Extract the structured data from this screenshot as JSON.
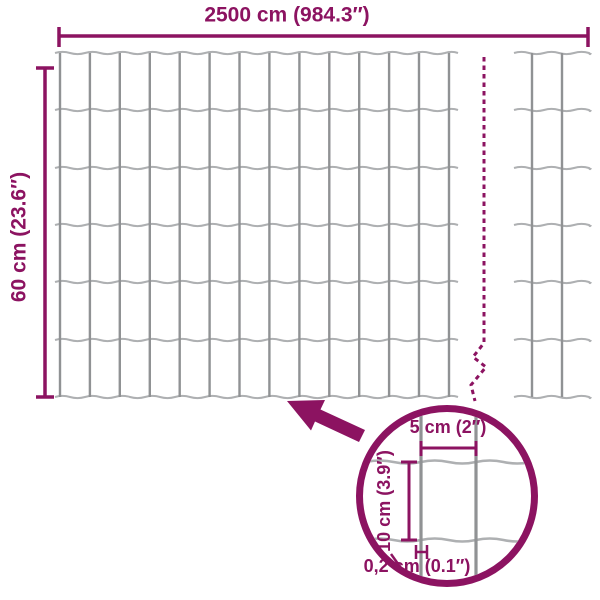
{
  "colors": {
    "accent": "#8c1361",
    "wire_vertical": "#909294",
    "wire_horizontal": "#aeb0b2",
    "background": "#ffffff"
  },
  "dimensions": {
    "width_label": "2500 cm (984.3″)",
    "height_label": "60 cm (23.6″)"
  },
  "detail": {
    "mesh_width_label": "5 cm (2″)",
    "mesh_height_label": "10 cm (3.9″)",
    "wire_thickness_label": "0,2 cm (0.1″)"
  }
}
